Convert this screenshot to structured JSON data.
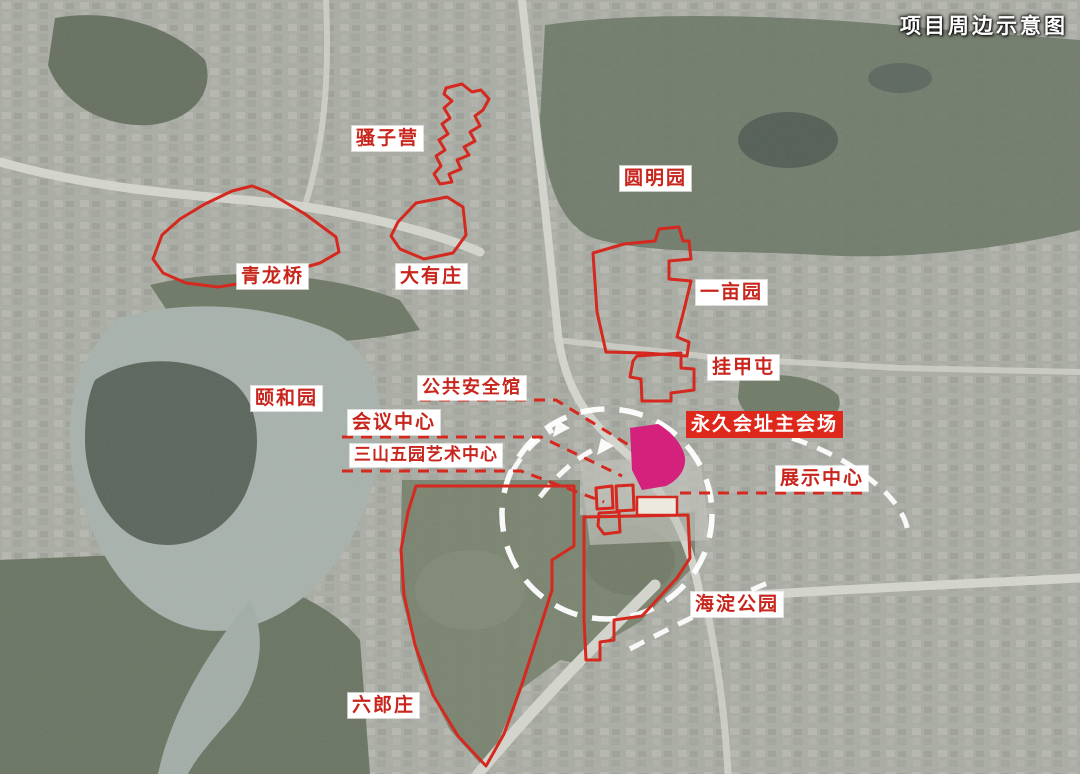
{
  "title": "项目周边示意图",
  "labels": {
    "saoziying": "骚子营",
    "yuanmingyuan": "圆明园",
    "qinglongqiao": "青龙桥",
    "dayouzhuang": "大有庄",
    "yimuyuan": "一亩园",
    "guajiatun": "挂甲屯",
    "yiheyuan": "颐和园",
    "public_safety_hall": "公共安全馆",
    "conference_center": "会议中心",
    "three_hills_five_gardens_art_center": "三山五园艺术中心",
    "permanent_venue_main_hall": "永久会址主会场",
    "exhibition_center": "展示中心",
    "haidian_park": "海淀公园",
    "liulangzhuang": "六郎庄"
  },
  "colors": {
    "annotation_red": "#d5281e",
    "venue_fill_magenta": "#d4217c",
    "label_text_red": "#c8251d",
    "label_background": "#ffffff",
    "highlight_label_background": "#df281c",
    "highlight_label_text": "#ffffff",
    "title_text": "#ffffff"
  }
}
